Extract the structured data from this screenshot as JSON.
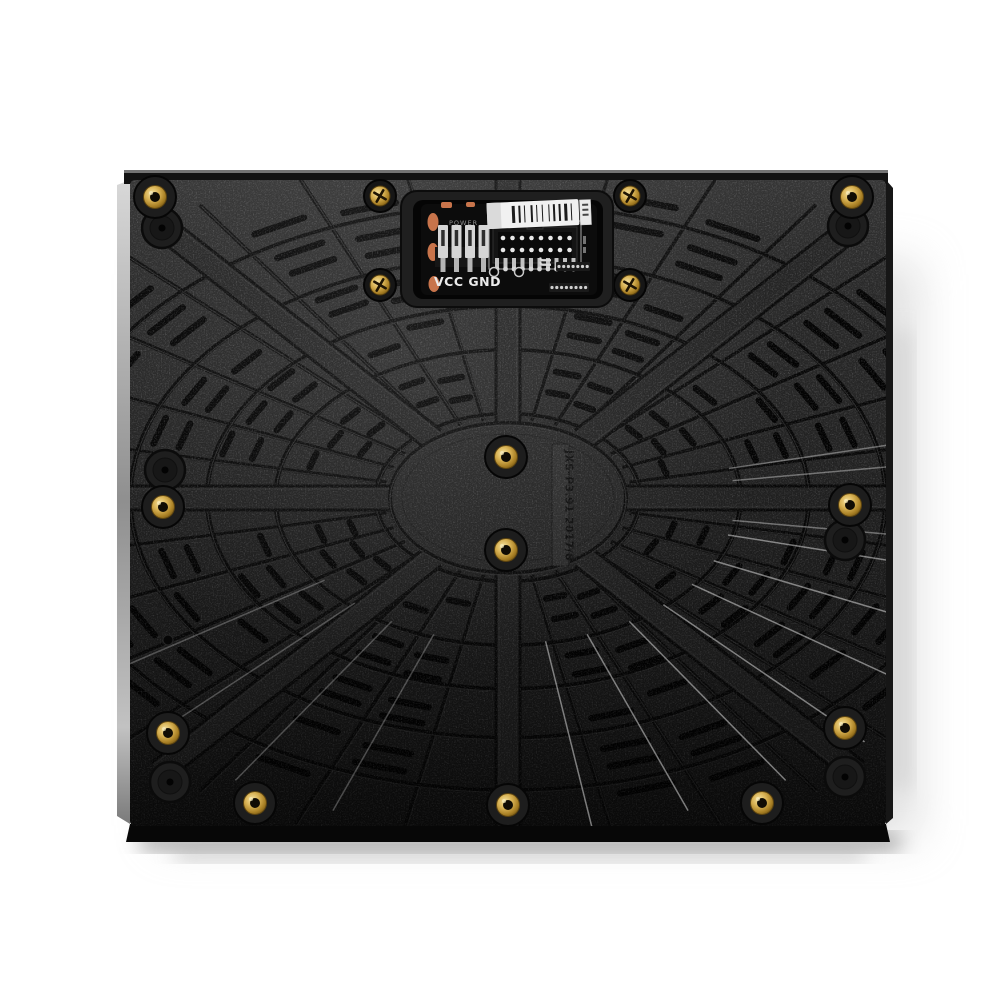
{
  "product": {
    "center_label": "JXS-P3.91 2017/8"
  },
  "pcb": {
    "power_label": "POWER",
    "vcc_gnd_label": "VCC GND",
    "jj_marking": "JJ"
  },
  "fastener_counts": {
    "brass_inserts": 11,
    "phillips_screws": 4,
    "blank_bosses": 6,
    "small_holes": 1
  },
  "colors": {
    "background": "#ffffff",
    "panel_body": "#232323",
    "panel_body_light": "#2a2a2a",
    "groove": "#060606",
    "slot": "#020202",
    "rib_highlight": "#3d3d3d",
    "shine_highlight": "#e8e8e8",
    "brass": "#c9a23c",
    "copper_pad": "#c8744b",
    "silkscreen_white": "#e6e6e6",
    "barcode_label": "#f1f1f1",
    "side_edge": "#c9c9c9"
  },
  "artwork": {
    "spoke_count": 32,
    "hub": {
      "cx": 508,
      "cy": 498,
      "rx": 118,
      "ry": 75
    },
    "ring_scales": [
      1.12,
      1.97,
      2.55,
      3.2,
      3.9
    ],
    "slot_rows": [
      1.38,
      1.66,
      2.16,
      2.42,
      2.8,
      3.02,
      3.44,
      3.68,
      4.05
    ],
    "structural_angles": [
      0,
      51,
      90,
      129,
      180,
      231,
      270,
      309
    ]
  }
}
